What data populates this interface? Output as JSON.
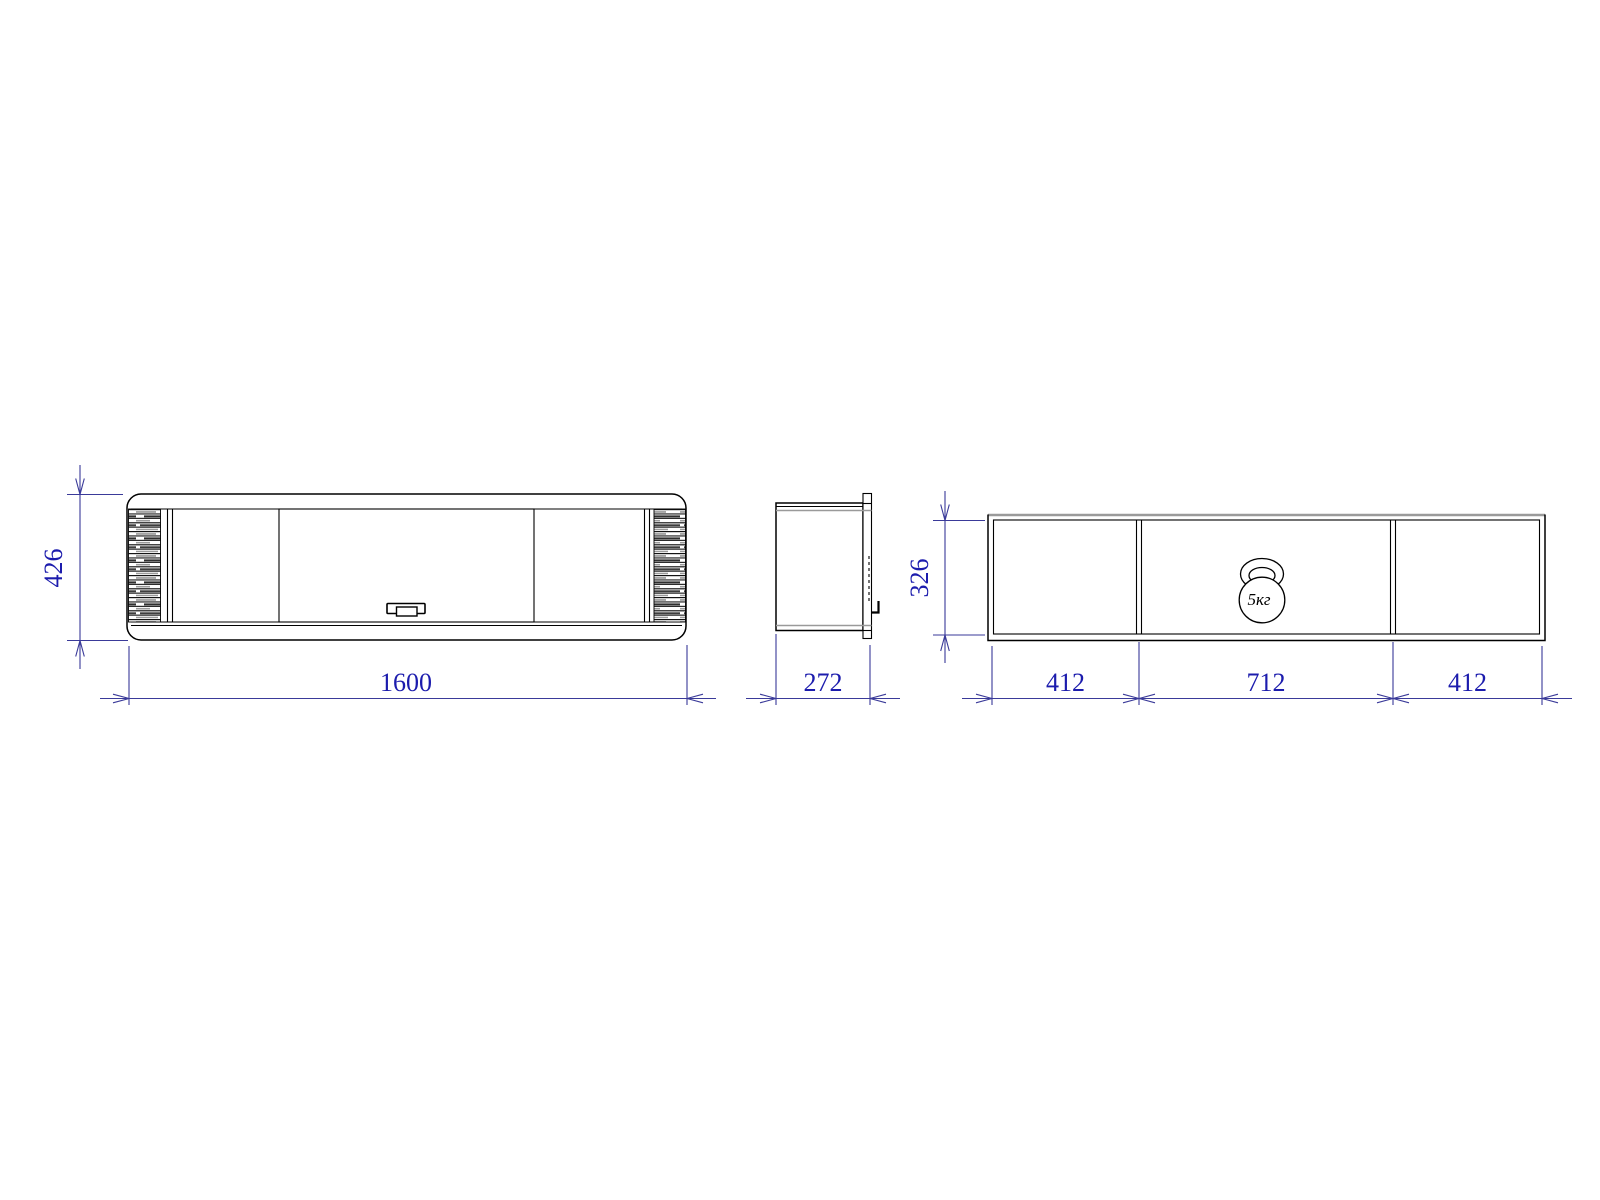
{
  "colors": {
    "outline": "#000000",
    "secondary_line": "#9a9a9a",
    "dimension_line": "#3a3a99",
    "dimension_text": "#1c1cad",
    "background": "#ffffff"
  },
  "front_view": {
    "height_dim": "426",
    "width_dim": "1600"
  },
  "side_view": {
    "depth_dim": "272"
  },
  "interior_view": {
    "height_dim": "326",
    "section_dims": [
      "412",
      "712",
      "412"
    ],
    "load_icon_label": "5кг"
  }
}
